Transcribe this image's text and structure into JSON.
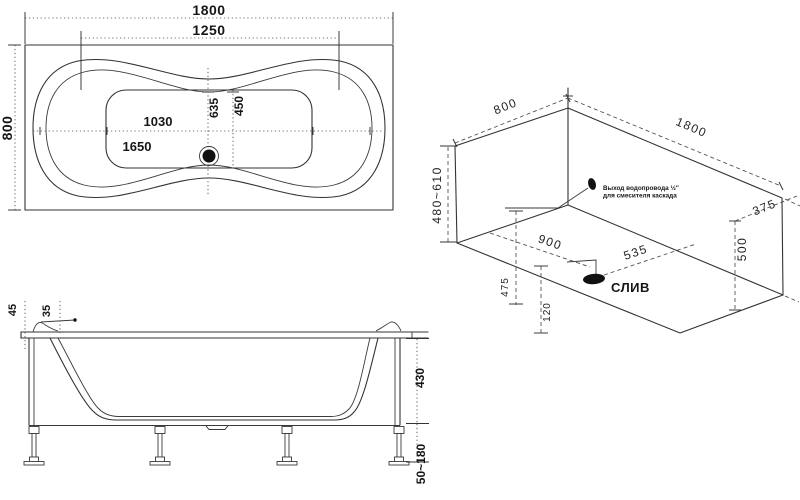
{
  "top_view": {
    "length_overall": "1800",
    "rim_length_inner": "1250",
    "width_overall": "800",
    "basin_length": "1030",
    "rim_length": "1650",
    "drain_offset_length": "635",
    "basin_width": "450"
  },
  "side_view": {
    "rim_edge_offset": "45",
    "rim_lip_offset": "35",
    "tub_depth": "430",
    "leg_height_range": "50~180"
  },
  "iso_view": {
    "width": "800",
    "length": "1800",
    "install_height_range": "480~610",
    "drain_from_end": "900",
    "outlet_offset": "535",
    "side_offset": "375",
    "height_500": "500",
    "drain_side_offset": "475",
    "drain_height": "120",
    "drain_label": "СЛИВ",
    "outlet_note_line1": "Выход водопровода ½″",
    "outlet_note_line2": "для смесителя каскада"
  }
}
